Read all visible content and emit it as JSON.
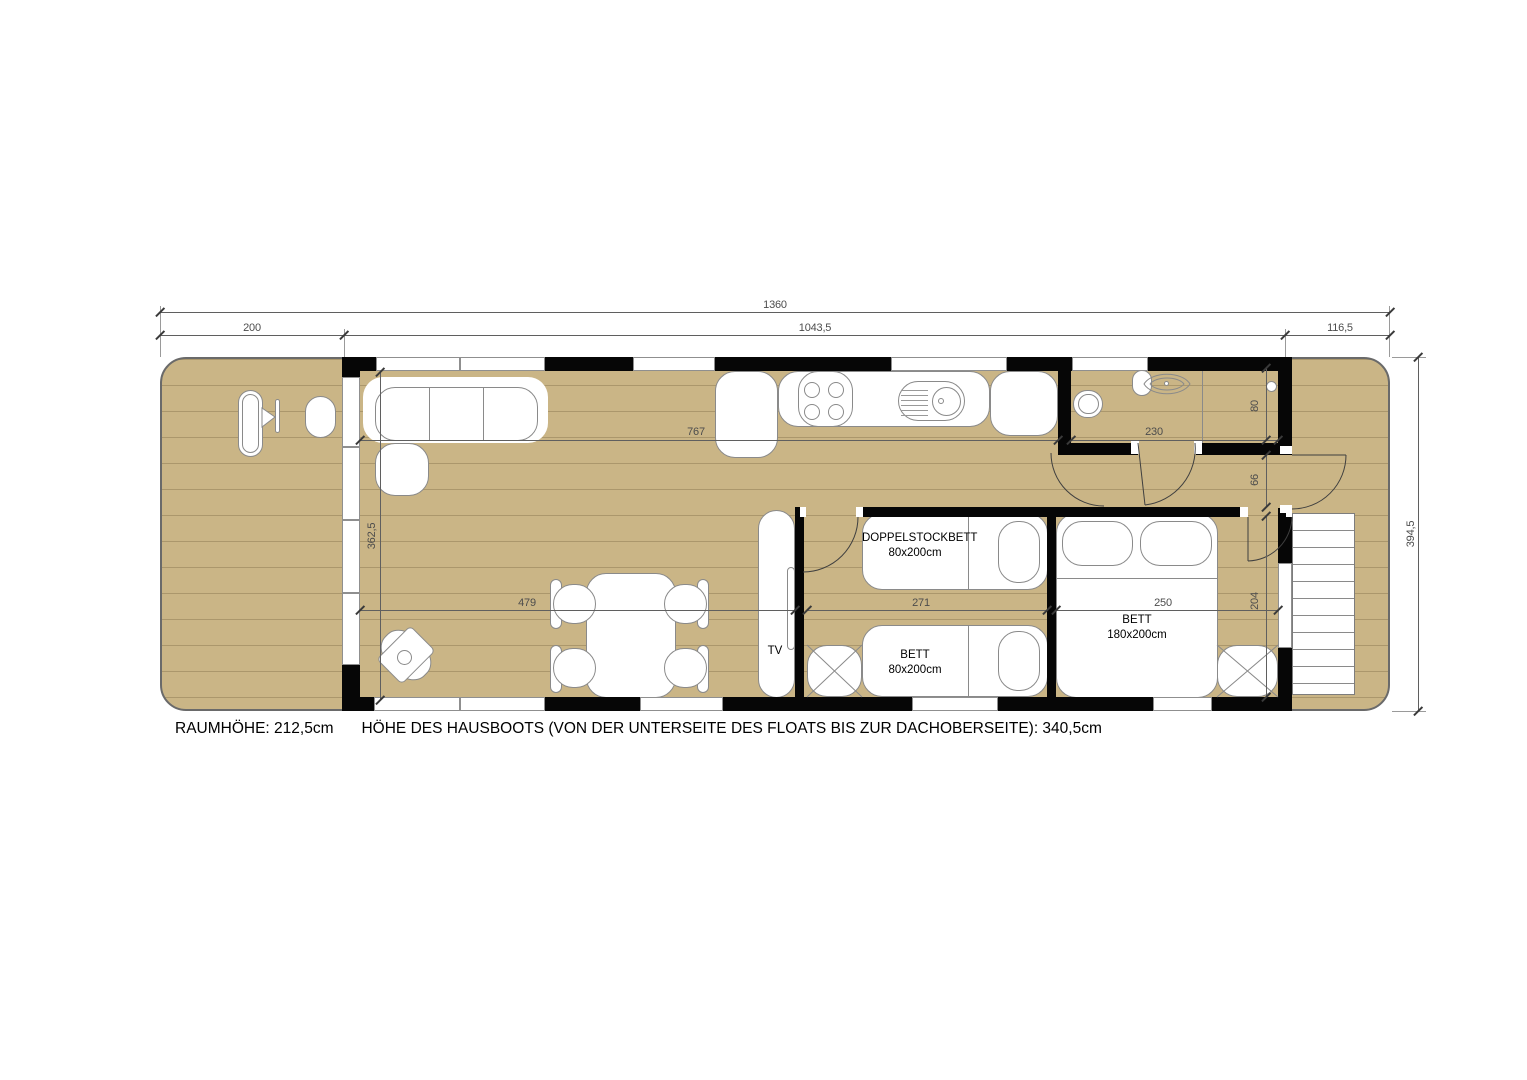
{
  "title": "Hausboot Grundriss",
  "dims": {
    "len_total": "1360",
    "len_left_terrace": "200",
    "len_cabin": "1043,5",
    "len_right_terrace": "116,5",
    "kitchen_run": "767",
    "bath_width": "230",
    "living_height": "362,5",
    "living_width": "479",
    "bunk_room_width": "271",
    "master_room_width": "250",
    "shower_depth": "80",
    "hall_depth": "66",
    "bedroom_depth": "204",
    "beam_total": "394,5"
  },
  "rooms": {
    "bunk_top": {
      "line1": "DOPPELSTOCKBETT",
      "line2": "80x200cm"
    },
    "bunk_bottom": {
      "line1": "BETT",
      "line2": "80x200cm"
    },
    "master": {
      "line1": "BETT",
      "line2": "180x200cm"
    },
    "tv": "TV"
  },
  "footer": {
    "room_height": "RAUMHÖHE: 212,5cm",
    "boat_height": "HÖHE DES HAUSBOOTS (VON DER UNTERSEITE DES FLOATS BIS ZUR DACHOBERSEITE): 340,5cm"
  },
  "colors": {
    "deck": "#cab586",
    "wall": "#060606",
    "furniture_outline": "#8a8a8a",
    "dimension": "#5f5f5f",
    "background": "#ffffff"
  }
}
